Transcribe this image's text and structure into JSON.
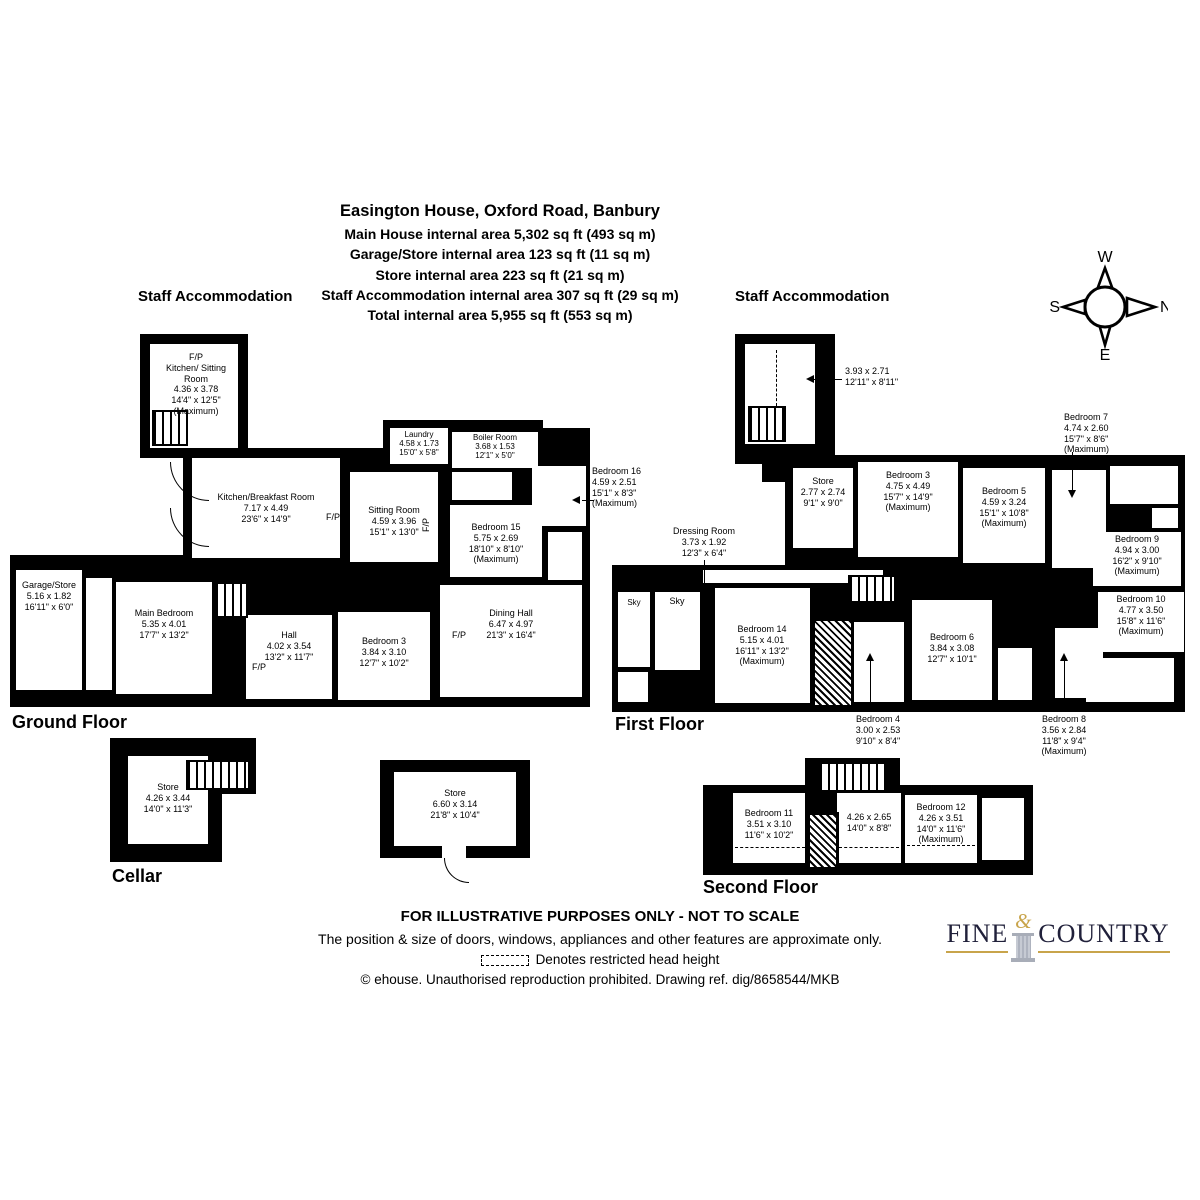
{
  "header": {
    "title": "Easington House, Oxford Road, Banbury",
    "area_lines": [
      "Main House internal area 5,302 sq ft (493 sq m)",
      "Garage/Store internal area 123 sq ft (11 sq m)",
      "Store internal area 223 sq ft (21 sq m)",
      "Staff Accommodation internal area 307 sq ft (29 sq m)",
      "Total internal area 5,955 sq ft (553 sq m)"
    ]
  },
  "compass": {
    "top": "W",
    "right": "N",
    "bottom": "E",
    "left": "S"
  },
  "sections": {
    "staff_accommodation_left": "Staff Accommodation",
    "staff_accommodation_right": "Staff Accommodation"
  },
  "floors": {
    "ground": "Ground Floor",
    "first": "First Floor",
    "second": "Second Floor",
    "cellar": "Cellar"
  },
  "fireplace_label": "F/P",
  "sky_label": "Sky",
  "rooms": {
    "sa_left": {
      "name": "Kitchen/ Sitting Room",
      "metric": "4.36 x 3.78",
      "imperial": "14'4\" x 12'5\"",
      "note": "(Maximum)"
    },
    "garage_store": {
      "name": "Garage/Store",
      "metric": "5.16 x 1.82",
      "imperial": "16'11\" x 6'0\""
    },
    "main_bedroom": {
      "name": "Main Bedroom",
      "metric": "5.35 x 4.01",
      "imperial": "17'7\" x 13'2\""
    },
    "hall": {
      "name": "Hall",
      "metric": "4.02 x 3.54",
      "imperial": "13'2\" x 11'7\""
    },
    "kitchen": {
      "name": "Kitchen/Breakfast Room",
      "metric": "7.17 x 4.49",
      "imperial": "23'6\" x 14'9\""
    },
    "laundry": {
      "name": "Laundry",
      "metric": "4.58 x 1.73",
      "imperial": "15'0\" x 5'8\""
    },
    "boiler": {
      "name": "Boiler Room",
      "metric": "3.68 x 1.53",
      "imperial": "12'1\" x 5'0\""
    },
    "sitting": {
      "name": "Sitting Room",
      "metric": "4.59 x 3.96",
      "imperial": "15'1\" x 13'0\""
    },
    "bed15": {
      "name": "Bedroom 15",
      "metric": "5.75 x 2.69",
      "imperial": "18'10\" x 8'10\"",
      "note": "(Maximum)"
    },
    "bed16": {
      "name": "Bedroom 16",
      "metric": "4.59 x 2.51",
      "imperial": "15'1\" x 8'3\"",
      "note": "(Maximum)"
    },
    "bed3_gf": {
      "name": "Bedroom 3",
      "metric": "3.84 x 3.10",
      "imperial": "12'7\" x 10'2\""
    },
    "dining": {
      "name": "Dining Hall",
      "metric": "6.47 x 4.97",
      "imperial": "21'3\" x 16'4\""
    },
    "sa_right": {
      "metric": "3.93 x 2.71",
      "imperial": "12'11\" x 8'11\""
    },
    "store_ff": {
      "name": "Store",
      "metric": "2.77 x 2.74",
      "imperial": "9'1\" x 9'0\""
    },
    "bed3_ff": {
      "name": "Bedroom 3",
      "metric": "4.75 x 4.49",
      "imperial": "15'7\" x 14'9\"",
      "note": "(Maximum)"
    },
    "bed5": {
      "name": "Bedroom 5",
      "metric": "4.59 x 3.24",
      "imperial": "15'1\" x 10'8\"",
      "note": "(Maximum)"
    },
    "bed7": {
      "name": "Bedroom 7",
      "metric": "4.74 x 2.60",
      "imperial": "15'7\" x 8'6\"",
      "note": "(Maximum)"
    },
    "bed9": {
      "name": "Bedroom 9",
      "metric": "4.94 x 3.00",
      "imperial": "16'2\" x 9'10\"",
      "note": "(Maximum)"
    },
    "dressing": {
      "name": "Dressing Room",
      "metric": "3.73 x 1.92",
      "imperial": "12'3\" x 6'4\""
    },
    "bed14": {
      "name": "Bedroom 14",
      "metric": "5.15 x 4.01",
      "imperial": "16'11\" x 13'2\"",
      "note": "(Maximum)"
    },
    "bed4": {
      "name": "Bedroom 4",
      "metric": "3.00 x 2.53",
      "imperial": "9'10\" x 8'4\""
    },
    "bed6": {
      "name": "Bedroom 6",
      "metric": "3.84 x 3.08",
      "imperial": "12'7\" x 10'1\""
    },
    "bed8": {
      "name": "Bedroom 8",
      "metric": "3.56 x 2.84",
      "imperial": "11'8\" x 9'4\"",
      "note": "(Maximum)"
    },
    "bed10": {
      "name": "Bedroom 10",
      "metric": "4.77 x 3.50",
      "imperial": "15'8\" x 11'6\"",
      "note": "(Maximum)"
    },
    "bed11": {
      "name": "Bedroom 11",
      "metric": "3.51 x 3.10",
      "imperial": "11'6\" x 10'2\""
    },
    "landing2f": {
      "metric": "4.26 x 2.65",
      "imperial": "14'0\" x 8'8\""
    },
    "bed12": {
      "name": "Bedroom 12",
      "metric": "4.26 x 3.51",
      "imperial": "14'0\" x 11'6\"",
      "note": "(Maximum)"
    },
    "cellar_store": {
      "name": "Store",
      "metric": "4.26 x 3.44",
      "imperial": "14'0\" x 11'3\""
    },
    "out_store": {
      "name": "Store",
      "metric": "6.60 x 3.14",
      "imperial": "21'8\" x 10'4\""
    }
  },
  "footer": {
    "line1": "FOR ILLUSTRATIVE PURPOSES ONLY - NOT TO SCALE",
    "line2": "The position & size of doors, windows, appliances and other features are approximate only.",
    "line3": "Denotes restricted head height",
    "line4": "© ehouse. Unauthorised reproduction prohibited. Drawing ref. dig/8658544/MKB"
  },
  "logo": {
    "word1": "FINE",
    "amp": "&",
    "word2": "COUNTRY"
  },
  "colors": {
    "wall": "#000000",
    "brand_gold": "#c8a44b",
    "brand_navy": "#20203a",
    "column_grey": "#aeb3bf"
  }
}
